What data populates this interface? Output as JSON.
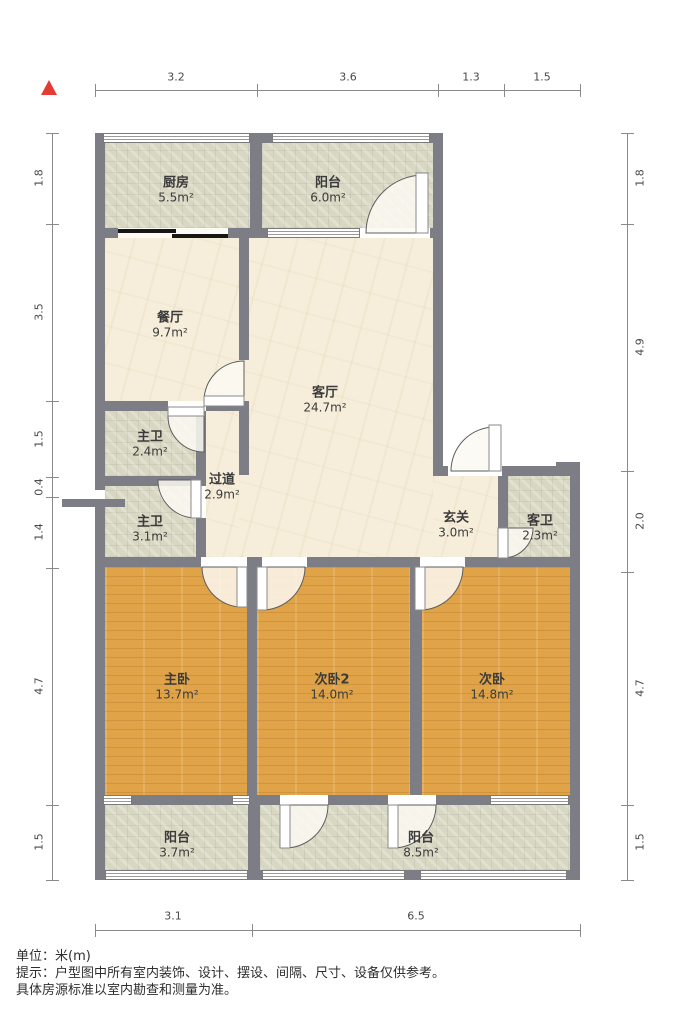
{
  "meta": {
    "unit_note": "单位：米(m)",
    "disclaimer_line1": "提示：户型图中所有室内装饰、设计、摆设、间隔、尺寸、设备仅供参考。",
    "disclaimer_line2": "具体房源标准以室内勘查和测量为准。"
  },
  "colors": {
    "wall": "#7d7d85",
    "wood_floor": "#e0a348",
    "tile_floor": "#d8d7c2",
    "marble_floor": "#f6eeda",
    "north_arrow": "#e23c34",
    "dimension_line": "#8a8a8a"
  },
  "north_indicator": "north-arrow",
  "dimensions": {
    "top": [
      "3.2",
      "3.6",
      "1.3",
      "1.5"
    ],
    "left": [
      "1.8",
      "3.5",
      "1.5",
      "0.4",
      "1.4",
      "4.7",
      "1.5"
    ],
    "right": [
      "1.8",
      "4.9",
      "2.0",
      "4.7",
      "1.5"
    ],
    "bottom": [
      "3.1",
      "6.5"
    ]
  },
  "rooms": [
    {
      "name": "厨房",
      "area": "5.5m²"
    },
    {
      "name": "阳台",
      "area": "6.0m²"
    },
    {
      "name": "餐厅",
      "area": "9.7m²"
    },
    {
      "name": "客厅",
      "area": "24.7m²"
    },
    {
      "name": "主卫",
      "area": "2.4m²"
    },
    {
      "name": "过道",
      "area": "2.9m²"
    },
    {
      "name": "主卫",
      "area": "3.1m²"
    },
    {
      "name": "玄关",
      "area": "3.0m²"
    },
    {
      "name": "客卫",
      "area": "2.3m²"
    },
    {
      "name": "主卧",
      "area": "13.7m²"
    },
    {
      "name": "次卧2",
      "area": "14.0m²"
    },
    {
      "name": "次卧",
      "area": "14.8m²"
    },
    {
      "name": "阳台",
      "area": "3.7m²"
    },
    {
      "name": "阳台",
      "area": "8.5m²"
    }
  ]
}
